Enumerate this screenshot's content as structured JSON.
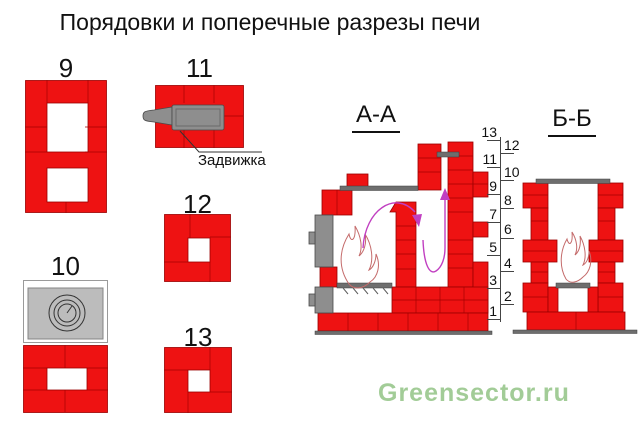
{
  "title": "Порядовки и поперечные разрезы печи",
  "watermark": "Greensector.ru",
  "courses": {
    "c9": "9",
    "c10": "10",
    "c11": "11",
    "c12": "12",
    "c13": "13"
  },
  "damper_label": "Задвижка",
  "sections": {
    "aa": "А-А",
    "bb": "Б-Б"
  },
  "row_scale": [
    "13",
    "12",
    "11",
    "10",
    "9",
    "8",
    "7",
    "6",
    "5",
    "4",
    "3",
    "2",
    "1"
  ],
  "colors": {
    "brick": "#ee1212",
    "joint": "#a40000",
    "gray": "#8e8e8e",
    "dark_gray": "#6e6e6e",
    "plate": "#bcbcbc",
    "flow_arrow": "#c13fc1",
    "flame": "#c46a6a",
    "watermark": "#a2cc97"
  }
}
